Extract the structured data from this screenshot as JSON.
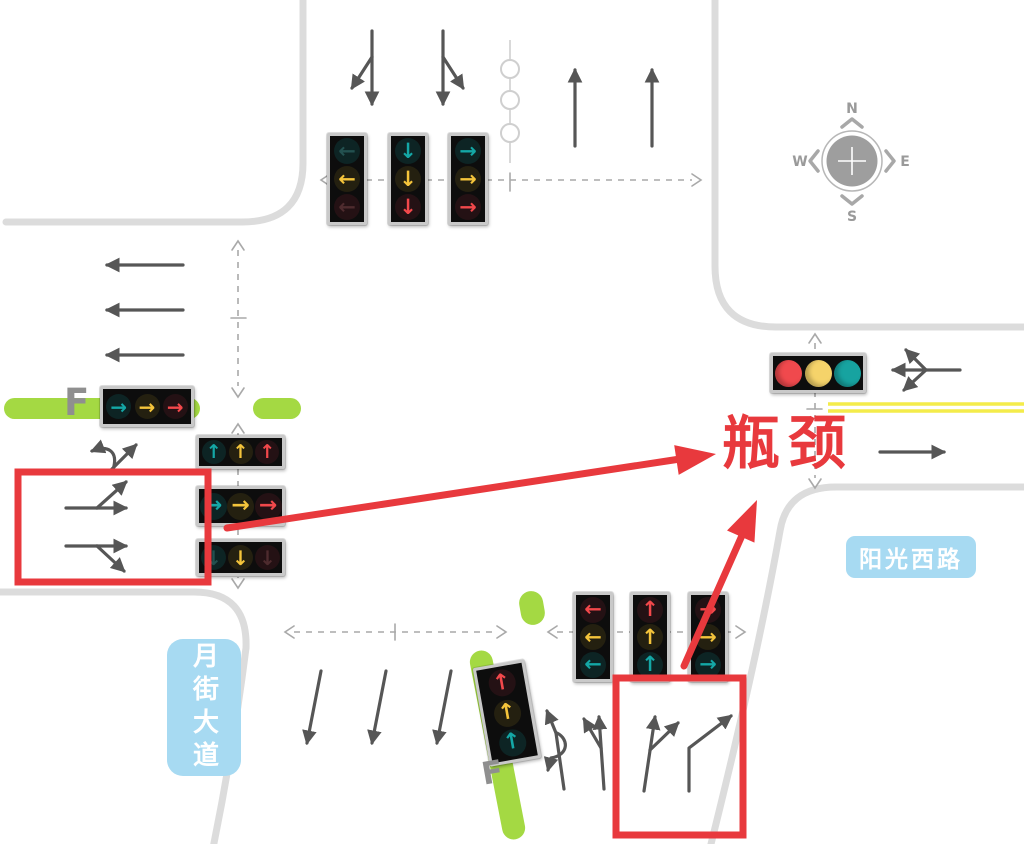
{
  "labels": {
    "bottleneck": "瓶颈",
    "east_road": "阳光西路",
    "south_road": "月街大道",
    "bus_lane_west": "F",
    "bus_lane_south": "F"
  },
  "compass": {
    "north": "N",
    "east": "E",
    "south": "S",
    "west": "W"
  },
  "colors": {
    "signal_red": "#F2484B",
    "signal_yellow": "#F4C43B",
    "signal_teal": "#14A7A6",
    "annotation_red": "#E8393D",
    "bus_lane_green": "#A4D943",
    "label_blue_bg": "#A7DAF2",
    "road_edge": "#DCDCDC",
    "lane_arrow": "#565656",
    "yellow_line": "#F4EC4A"
  },
  "glyphs": {
    "up": "↑",
    "down": "↓",
    "left": "←",
    "right": "→"
  },
  "signals": [
    {
      "id": "north-left-turn",
      "x": 327,
      "y": 133,
      "w": 40,
      "h": 92,
      "lamp": 26,
      "vertical": true,
      "lamps": [
        {
          "dir": "left",
          "color": "teal",
          "dim": true
        },
        {
          "dir": "left",
          "color": "yellow"
        },
        {
          "dir": "left",
          "color": "red",
          "dim": true
        }
      ]
    },
    {
      "id": "north-straight",
      "x": 388,
      "y": 133,
      "w": 40,
      "h": 92,
      "lamp": 26,
      "vertical": true,
      "lamps": [
        {
          "dir": "down",
          "color": "teal"
        },
        {
          "dir": "down",
          "color": "yellow"
        },
        {
          "dir": "down",
          "color": "red"
        }
      ]
    },
    {
      "id": "north-right-turn",
      "x": 448,
      "y": 133,
      "w": 40,
      "h": 92,
      "lamp": 26,
      "vertical": true,
      "lamps": [
        {
          "dir": "right",
          "color": "teal"
        },
        {
          "dir": "right",
          "color": "yellow"
        },
        {
          "dir": "right",
          "color": "red"
        }
      ]
    },
    {
      "id": "west-bus-lane",
      "x": 100,
      "y": 386,
      "w": 94,
      "h": 41,
      "lamp": 25,
      "vertical": false,
      "lamps": [
        {
          "dir": "right",
          "color": "teal"
        },
        {
          "dir": "right",
          "color": "yellow"
        },
        {
          "dir": "right",
          "color": "red"
        }
      ]
    },
    {
      "id": "west-straight",
      "x": 196,
      "y": 435,
      "w": 89,
      "h": 34,
      "lamp": 24,
      "vertical": false,
      "lamps": [
        {
          "dir": "up",
          "color": "teal"
        },
        {
          "dir": "up",
          "color": "yellow"
        },
        {
          "dir": "up",
          "color": "red"
        }
      ]
    },
    {
      "id": "west-right-turn",
      "x": 196,
      "y": 486,
      "w": 89,
      "h": 40,
      "lamp": 27,
      "vertical": false,
      "lamps": [
        {
          "dir": "right",
          "color": "teal"
        },
        {
          "dir": "right",
          "color": "yellow"
        },
        {
          "dir": "right",
          "color": "red"
        }
      ]
    },
    {
      "id": "west-down",
      "x": 196,
      "y": 539,
      "w": 89,
      "h": 37,
      "lamp": 25,
      "vertical": false,
      "lamps": [
        {
          "dir": "down",
          "color": "teal",
          "dim": true
        },
        {
          "dir": "down",
          "color": "yellow"
        },
        {
          "dir": "down",
          "color": "red",
          "dim": true
        }
      ]
    },
    {
      "id": "south-left-turn",
      "x": 573,
      "y": 592,
      "w": 40,
      "h": 90,
      "lamp": 26,
      "vertical": true,
      "lamps": [
        {
          "dir": "left",
          "color": "red"
        },
        {
          "dir": "left",
          "color": "yellow"
        },
        {
          "dir": "left",
          "color": "teal"
        }
      ]
    },
    {
      "id": "south-straight",
      "x": 630,
      "y": 592,
      "w": 40,
      "h": 90,
      "lamp": 26,
      "vertical": true,
      "lamps": [
        {
          "dir": "up",
          "color": "red"
        },
        {
          "dir": "up",
          "color": "yellow"
        },
        {
          "dir": "up",
          "color": "teal"
        }
      ]
    },
    {
      "id": "south-right-turn",
      "x": 688,
      "y": 592,
      "w": 40,
      "h": 90,
      "lamp": 26,
      "vertical": true,
      "lamps": [
        {
          "dir": "right",
          "color": "red"
        },
        {
          "dir": "right",
          "color": "yellow"
        },
        {
          "dir": "right",
          "color": "teal"
        }
      ]
    },
    {
      "id": "south-bus-lane",
      "x": 481,
      "y": 663,
      "w": 52,
      "h": 100,
      "lamp": 27,
      "vertical": true,
      "rotate": -10,
      "lamps": [
        {
          "dir": "up",
          "color": "red"
        },
        {
          "dir": "up",
          "color": "yellow"
        },
        {
          "dir": "up",
          "color": "teal"
        }
      ]
    },
    {
      "id": "east-approach",
      "x": 770,
      "y": 353,
      "w": 96,
      "h": 40,
      "lamp": 27,
      "vertical": false,
      "lamps": [
        {
          "color": "red"
        },
        {
          "color": "yellow"
        },
        {
          "color": "teal"
        }
      ]
    }
  ]
}
